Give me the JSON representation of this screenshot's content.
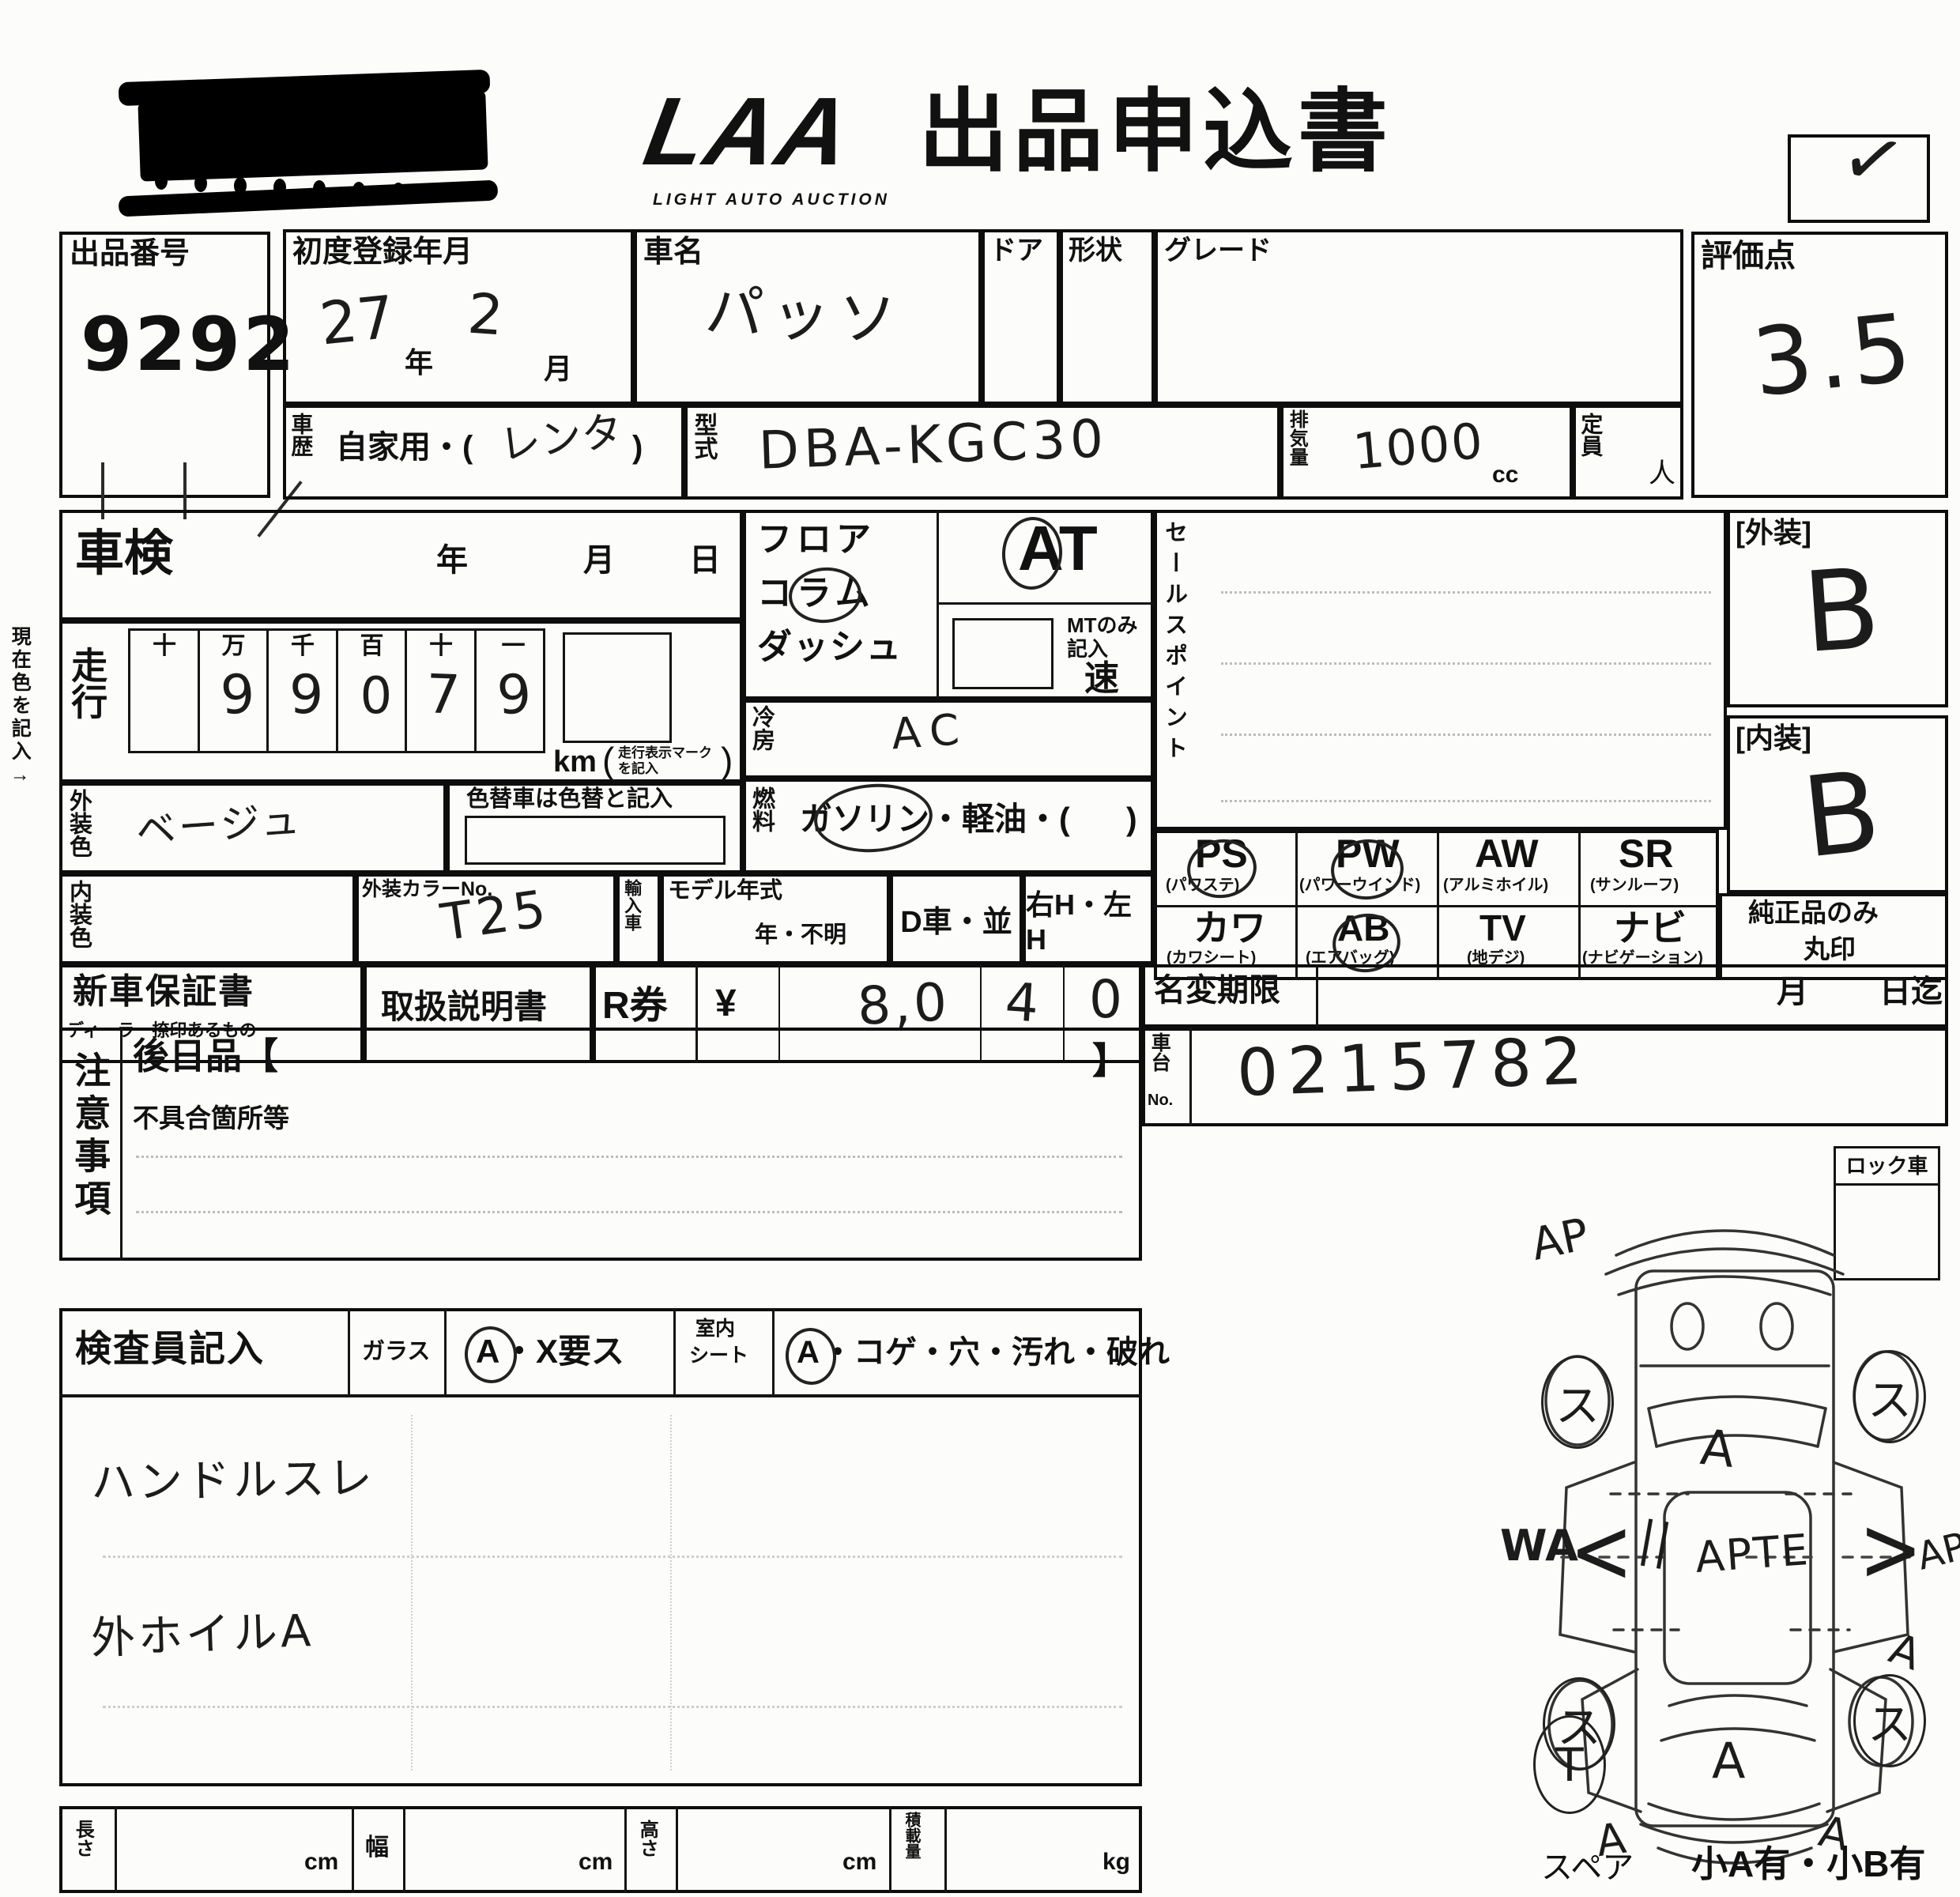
{
  "header": {
    "logo": "LAA",
    "logo_sub": "LIGHT AUTO AUCTION",
    "title": "出品申込書",
    "check_mark": "✓"
  },
  "lot": {
    "label": "出品番号",
    "number": "9292"
  },
  "registration": {
    "label": "初度登録年月",
    "year_value": "27",
    "year_unit": "年",
    "month_value": "2",
    "month_unit": "月"
  },
  "car_name": {
    "label": "車名",
    "value": "パッソ"
  },
  "door": {
    "label": "ドア"
  },
  "shape": {
    "label": "形状"
  },
  "grade": {
    "label": "グレード"
  },
  "rating": {
    "label": "評価点",
    "value": "3.5"
  },
  "history": {
    "label": "車歴",
    "printed": "自家用・(",
    "written": "レンタ",
    "printed_close": ")"
  },
  "model_code": {
    "label": "型式",
    "value": "DBA-KGC30"
  },
  "displacement": {
    "label": "排気量",
    "value": "1000",
    "unit": "cc"
  },
  "capacity": {
    "label": "定員",
    "unit": "人"
  },
  "margin_note": "現在色を記入→",
  "shaken": {
    "label": "車検",
    "year_unit": "年",
    "month_unit": "月",
    "day_unit": "日"
  },
  "mileage": {
    "label": "走行",
    "digit_headers": [
      "十",
      "万",
      "千",
      "百",
      "十",
      "一"
    ],
    "digits": [
      "",
      "9",
      "9",
      "0",
      "7",
      "9"
    ],
    "unit": "km",
    "unit_note_line1": "走行表示マーク",
    "unit_note_line2": "を記入",
    "color_change_note": "色替車は色替と記入"
  },
  "exterior_color": {
    "label": "外装色",
    "value": "ベージュ"
  },
  "interior_color": {
    "label": "内装色"
  },
  "color_no": {
    "label": "外装カラーNo.",
    "value": "T25"
  },
  "import_car": {
    "label": "輸入車"
  },
  "model_year": {
    "label": "モデル年式",
    "value": "年・不明"
  },
  "dealer_car": {
    "label": "D車・並"
  },
  "steering": {
    "label": "右H・左H"
  },
  "shift": {
    "line1": "フロア",
    "line2": "コラム",
    "line3": "ダッシュ",
    "at_value": "AT",
    "mt_note1": "MTのみ",
    "mt_note2": "記入",
    "speed_unit": "速"
  },
  "aircon": {
    "label": "冷房",
    "value": "AC"
  },
  "fuel": {
    "label": "燃料",
    "gasoline": "ガソリン",
    "rest": "・軽油・(",
    "close": ")"
  },
  "sales_point": {
    "label": "セールスポイント"
  },
  "exterior_grade": {
    "label": "[外装]",
    "value": "B"
  },
  "interior_grade": {
    "label": "[内装]",
    "value": "B"
  },
  "equipment": {
    "row1": [
      {
        "code": "PS",
        "name": "(パワステ)",
        "circled": true
      },
      {
        "code": "PW",
        "name": "(パワーウインド)",
        "circled": true
      },
      {
        "code": "AW",
        "name": "(アルミホイル)",
        "circled": false
      },
      {
        "code": "SR",
        "name": "(サンルーフ)",
        "circled": false
      }
    ],
    "row2": [
      {
        "code": "カワ",
        "name": "(カワシート)",
        "circled": false
      },
      {
        "code": "AB",
        "name": "(エアバッグ)",
        "circled": true
      },
      {
        "code": "TV",
        "name": "(地デジ)",
        "circled": false
      },
      {
        "code": "ナビ",
        "name": "(ナビゲーション)",
        "circled": false
      }
    ],
    "genuine_note1": "純正品のみ",
    "genuine_note2": "丸印"
  },
  "warranty": {
    "label": "新車保証書",
    "sub": "ディーラー捺印あるもの"
  },
  "manual": {
    "label": "取扱説明書"
  },
  "r_ticket": {
    "label": "R券",
    "currency": "¥",
    "cells": [
      "8,0",
      "4",
      "0"
    ]
  },
  "name_change": {
    "label": "名変期限",
    "month_unit": "月",
    "until": "日迄"
  },
  "chassis": {
    "label_top": "車台",
    "label_no": "No.",
    "value": "0215782"
  },
  "lock_car": {
    "label": "ロック車"
  },
  "notes": {
    "label": "注意事項",
    "later_item": "後日品【",
    "bracket_close": "】",
    "defect_label": "不具合箇所等"
  },
  "inspector": {
    "label": "検査員記入",
    "glass_label": "ガラス",
    "glass_a": "A",
    "glass_rest": "・X要ス",
    "seat_line1": "室内",
    "seat_line2": "シート",
    "seat_a": "A",
    "seat_rest": "・コゲ・穴・汚れ・破れ",
    "note1": "ハンドルスレ",
    "note2": "外ホイルA"
  },
  "dimensions": {
    "length_label": "長さ",
    "width_label": "幅",
    "height_label": "高さ",
    "load_label": "積載量",
    "cm": "cm",
    "kg": "kg"
  },
  "diagram": {
    "ap": "AP",
    "a": "A",
    "wa": "WA",
    "arrow_left": "<",
    "ticks": "||",
    "apte": "APTE",
    "arrow_right": ">",
    "su": "ス",
    "t": "T",
    "spare_label": "スペア",
    "corner_note": "小A有・小B有"
  }
}
